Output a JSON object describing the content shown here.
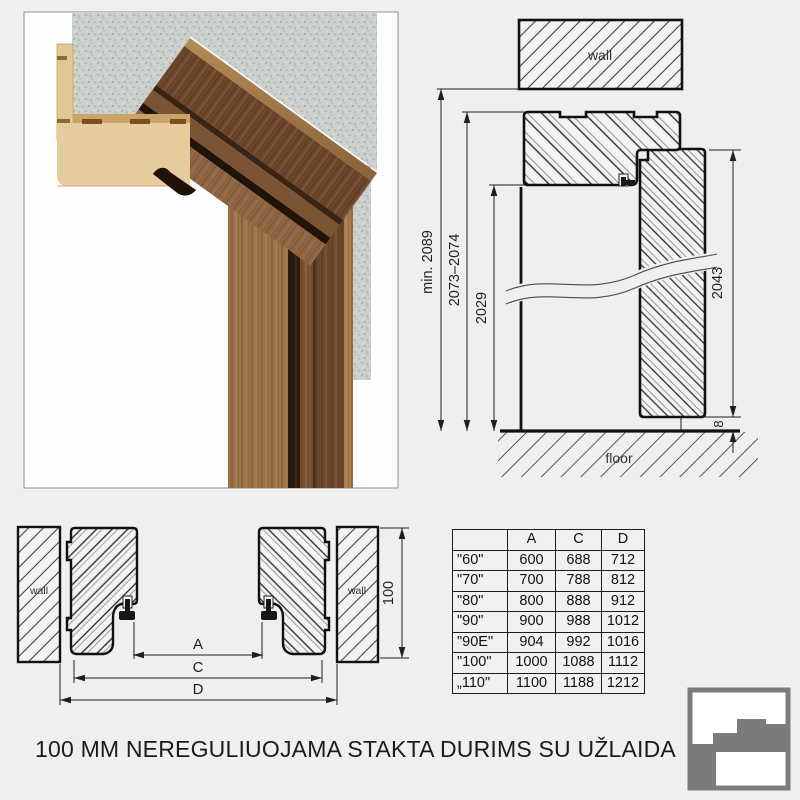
{
  "caption": "100 MM NEREGULIUOJAMA STAKTA DURIMS SU UŽLAIDA",
  "vertical_section": {
    "wall_label": "wall",
    "floor_label": "floor",
    "dim_min_height": "min. 2089",
    "dim_frame_height": "2073–2074",
    "dim_clear_opening": "2029",
    "dim_leaf_height": "2043",
    "dim_floor_gap": "8"
  },
  "horizontal_section": {
    "wall_left_label": "wall",
    "wall_right_label": "wall",
    "dim_depth": "100",
    "dim_a_label": "A",
    "dim_c_label": "C",
    "dim_d_label": "D"
  },
  "size_table": {
    "columns": [
      "",
      "A",
      "C",
      "D"
    ],
    "rows": [
      [
        "\"60\"",
        "600",
        "688",
        "712"
      ],
      [
        "\"70\"",
        "700",
        "788",
        "812"
      ],
      [
        "\"80\"",
        "800",
        "888",
        "912"
      ],
      [
        "\"90\"",
        "900",
        "988",
        "1012"
      ],
      [
        "\"90E\"",
        "904",
        "992",
        "1016"
      ],
      [
        "\"100\"",
        "1000",
        "1088",
        "1112"
      ],
      [
        "„110\"",
        "1100",
        "1188",
        "1212"
      ]
    ]
  }
}
